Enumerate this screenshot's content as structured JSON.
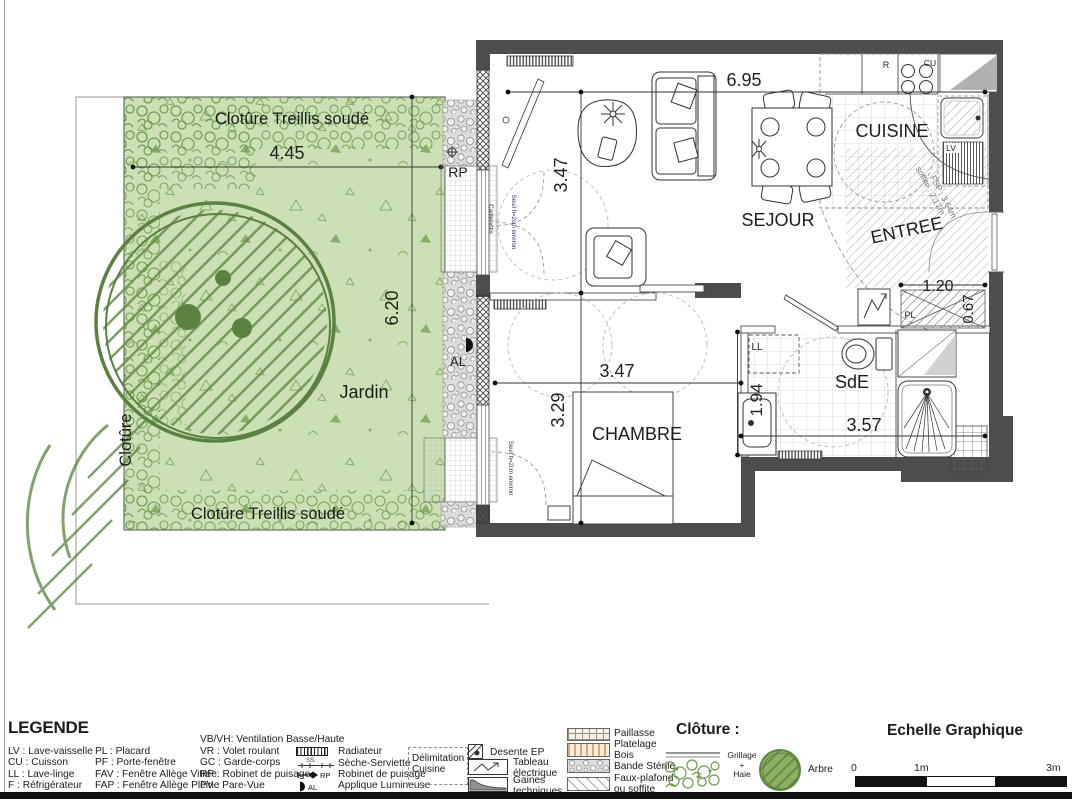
{
  "plan": {
    "rooms": {
      "sejour": "SEJOUR",
      "cuisine": "CUISINE",
      "entree": "ENTREE",
      "chambre": "CHAMBRE",
      "sde": "SdE",
      "jardin": "Jardin"
    },
    "dims": {
      "d695": "6.95",
      "d347a": "3.47",
      "d347b": "3.47",
      "d329": "3.29",
      "d445": "4.45",
      "d620": "6.20",
      "d194": "1.94",
      "d357": "3.57",
      "d120": "1.20",
      "d067": "0.67"
    },
    "fence": {
      "top": "Clotûre Treillis soudé",
      "bottom": "Clotûre Treillis soudé",
      "left": "Clotûre"
    },
    "labels": {
      "rp": "RP",
      "al": "AL",
      "pl": "PL",
      "ll": "LL",
      "lv": "LV",
      "r": "R",
      "cu": "CU",
      "caillebotis": "Caillebotis",
      "seuil": "Seuil h=2cm environ",
      "soffite_line1": "soffite : 2,17m",
      "soffite_line2": "FSP : 3,64m"
    }
  },
  "legend": {
    "title": "LEGENDE",
    "col1": [
      "LV : Lave-vaisselle",
      "CU : Cuisson",
      "LL : Lave-linge",
      "F : Réfrigérateur"
    ],
    "col2": [
      "PL : Placard",
      "PF : Porte-fenêtre",
      "FAV : Fenêtre Allège Vitrée",
      "FAP : Fenêtre Allège Pleine"
    ],
    "col3_header": "VB/VH: Ventilation Basse/Haute",
    "col3": [
      "VR : Volet roulant",
      "GC : Garde-corps",
      "RP : Robinet de puisage",
      "PV : Pare-Vue"
    ],
    "sym": {
      "radiateur": "Radiateur",
      "seche": "Sèche-Serviette",
      "robinet": "Robinet de puisage",
      "applique": "Applique Lumineuse",
      "ss": "SS.",
      "rp": "RP",
      "al": "AL"
    },
    "delim1": "Délimitation",
    "delim2": "Cuisine",
    "col5": {
      "desente": "Desente EP",
      "tableau1": "Tableau",
      "tableau2": "électrique",
      "gaines1": "Gaines",
      "gaines2": "techniques"
    },
    "col6": {
      "paillasse": "Paillasse",
      "platelage1": "Platelage",
      "platelage2": "Bois",
      "bande": "Bande Stérile",
      "faux1": "Faux-plafond",
      "faux2": "ou soffite"
    }
  },
  "cloture": {
    "title": "Clôture :",
    "grillage": "Grillage",
    "plus": "+",
    "haie": "Haie",
    "arbre": "Arbre"
  },
  "echelle": {
    "title": "Echelle Graphique",
    "t0": "0",
    "t1": "1m",
    "t3": "3m"
  }
}
